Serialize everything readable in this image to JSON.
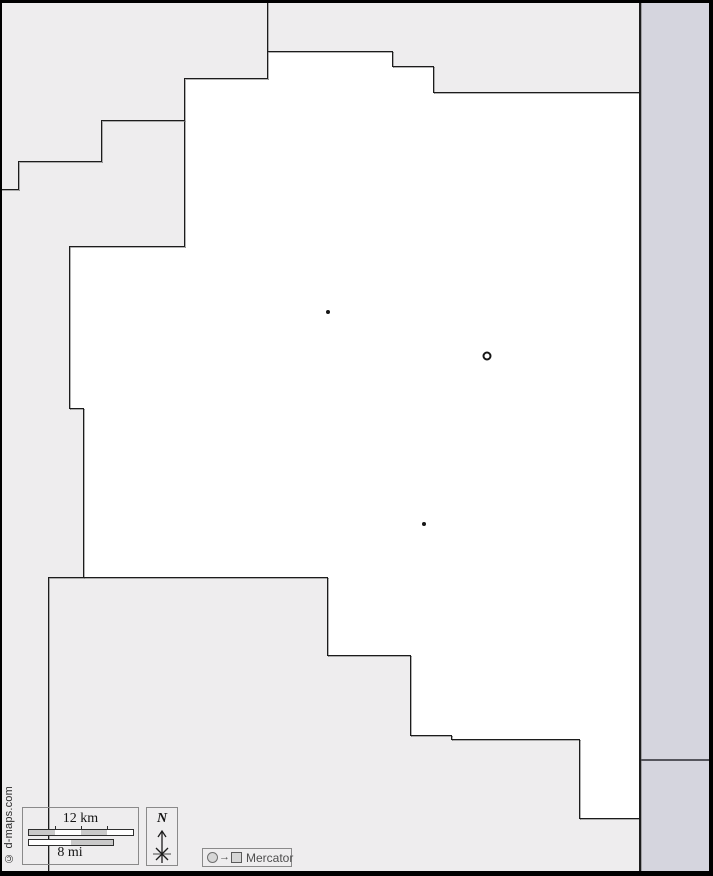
{
  "attribution": {
    "text": "© d-maps.com"
  },
  "scale": {
    "km_label": "12 km",
    "mi_label": "8 mi"
  },
  "compass": {
    "north_label": "N"
  },
  "projection": {
    "name": "Mercator",
    "arrow": "→"
  },
  "colors": {
    "neighbor_gray": "#eeedee",
    "strip_lavender": "#d5d5de",
    "county_white": "#ffffff",
    "line": "#1c1c1c",
    "line_shadow": "rgba(125,125,125,0.6)",
    "strip_divider": "#55555c",
    "frame": "#000000"
  },
  "map": {
    "regions": [
      {
        "name": "neighbor-region-northwest",
        "color": "neighbor_gray",
        "poly": "0px 0px, 268px 0px, 268px 79px, 185px 79px, 185px 121px, 102px 121px, 102px 162px, 19px 162px, 19px 190px, 0px 190px"
      },
      {
        "name": "neighbor-region-northeast",
        "color": "neighbor_gray",
        "poly": "268px 0px, 640px 0px, 640px 93px, 434px 93px, 434px 67px, 393px 67px, 393px 51px, 268px 51px"
      },
      {
        "name": "neighbor-region-west",
        "color": "neighbor_gray",
        "poly": "0px 190px, 19px 190px, 19px 162px, 102px 162px, 102px 121px, 185px 121px, 185px 247px, 69px 247px, 69px 409px, 83px 409px, 83px 578px, 48px 578px, 48px 876px, 0px 876px"
      },
      {
        "name": "neighbor-region-southwest",
        "color": "neighbor_gray",
        "poly": "48px 578px, 327px 578px, 327px 655px, 410px 655px, 410px 736px, 451px 736px, 451px 739px, 579px 739px, 579px 818px, 640px 818px, 640px 876px, 48px 876px"
      },
      {
        "name": "east-strip-upper",
        "color": "strip_lavender",
        "poly": "639px 0px, 713px 0px, 713px 761px, 639px 761px"
      },
      {
        "name": "east-strip-lower",
        "color": "strip_lavender",
        "poly": "639px 761px, 713px 761px, 713px 876px, 639px 876px"
      }
    ],
    "boundaries": [
      {
        "x": 267,
        "y": 0,
        "len": 79,
        "o": "v"
      },
      {
        "x": 267,
        "y": 51,
        "len": 126,
        "o": "h"
      },
      {
        "x": 392,
        "y": 51,
        "len": 16,
        "o": "v"
      },
      {
        "x": 392,
        "y": 66,
        "len": 42,
        "o": "h"
      },
      {
        "x": 433,
        "y": 66,
        "len": 27,
        "o": "v"
      },
      {
        "x": 433,
        "y": 92,
        "len": 207,
        "o": "h"
      },
      {
        "x": 185,
        "y": 78,
        "len": 83,
        "o": "h"
      },
      {
        "x": 184,
        "y": 78,
        "len": 169,
        "o": "v"
      },
      {
        "x": 102,
        "y": 120,
        "len": 83,
        "o": "h"
      },
      {
        "x": 101,
        "y": 120,
        "len": 42,
        "o": "v"
      },
      {
        "x": 19,
        "y": 161,
        "len": 83,
        "o": "h"
      },
      {
        "x": 18,
        "y": 161,
        "len": 29,
        "o": "v"
      },
      {
        "x": 0,
        "y": 189,
        "len": 19,
        "o": "h"
      },
      {
        "x": 69,
        "y": 246,
        "len": 116,
        "o": "h"
      },
      {
        "x": 69,
        "y": 246,
        "len": 163,
        "o": "v"
      },
      {
        "x": 69,
        "y": 408,
        "len": 15,
        "o": "h"
      },
      {
        "x": 83,
        "y": 408,
        "len": 170,
        "o": "v"
      },
      {
        "x": 48,
        "y": 577,
        "len": 280,
        "o": "h"
      },
      {
        "x": 48,
        "y": 577,
        "len": 294,
        "o": "v"
      },
      {
        "x": 327,
        "y": 577,
        "len": 79,
        "o": "v"
      },
      {
        "x": 327,
        "y": 655,
        "len": 84,
        "o": "h"
      },
      {
        "x": 410,
        "y": 655,
        "len": 81,
        "o": "v"
      },
      {
        "x": 410,
        "y": 735,
        "len": 42,
        "o": "h"
      },
      {
        "x": 451,
        "y": 735,
        "len": 5,
        "o": "v"
      },
      {
        "x": 451,
        "y": 739,
        "len": 129,
        "o": "h"
      },
      {
        "x": 579,
        "y": 739,
        "len": 80,
        "o": "v"
      },
      {
        "x": 579,
        "y": 818,
        "len": 61,
        "o": "h"
      },
      {
        "x": 639,
        "y": 0,
        "len": 876,
        "o": "v",
        "w": 2
      },
      {
        "x": 641,
        "y": 759,
        "len": 71,
        "o": "h",
        "w": 2,
        "color": "#55555c",
        "noshadow": true
      }
    ],
    "markers": [
      {
        "type": "dot",
        "x": 328,
        "y": 312
      },
      {
        "type": "ring",
        "x": 487,
        "y": 356
      },
      {
        "type": "dot",
        "x": 424,
        "y": 524
      }
    ]
  }
}
